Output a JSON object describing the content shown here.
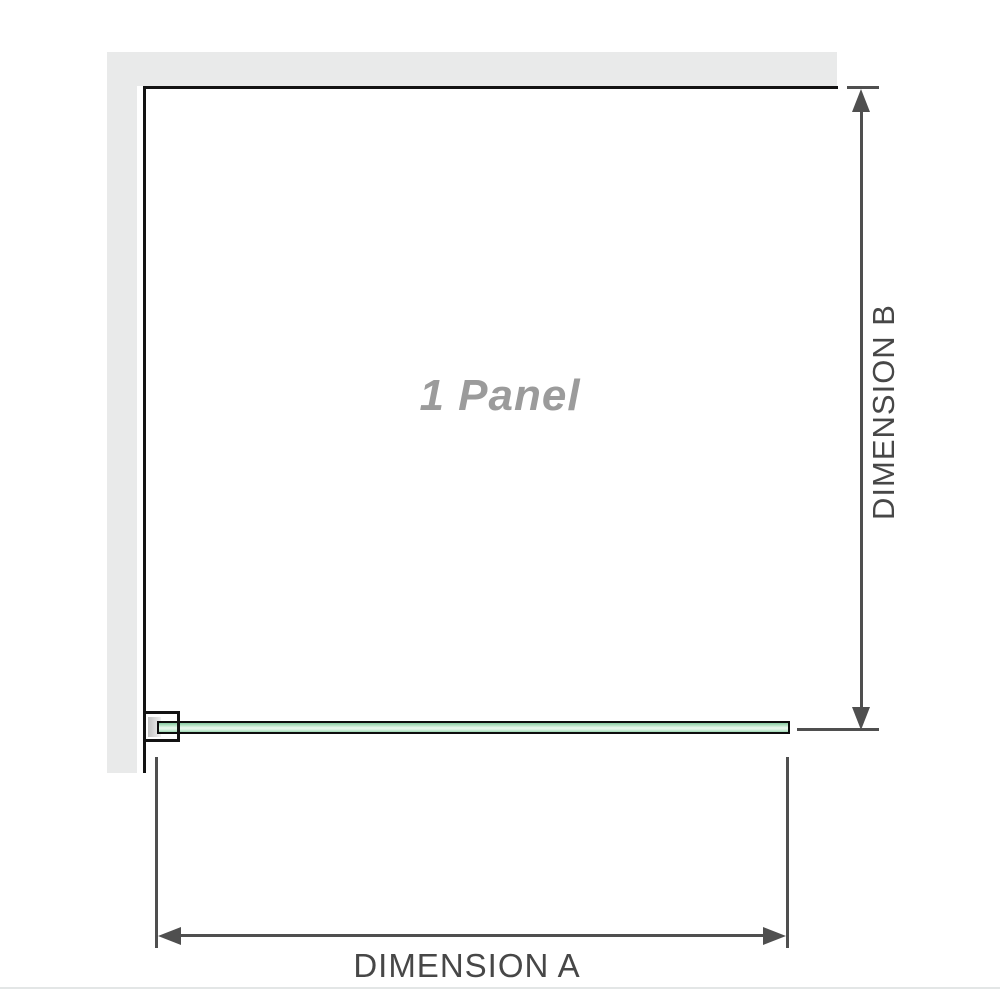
{
  "diagram": {
    "panel_label": "1 Panel",
    "dimension_a_label": "DIMENSION A",
    "dimension_b_label": "DIMENSION B"
  },
  "colors": {
    "wall": "#e9eaea",
    "outline": "#131313",
    "dimension": "#4f4f4f",
    "label": "#474747",
    "panel-label": "#9b9b9b",
    "glass-light": "#ecf9f0",
    "glass-border": "#0d0d0d",
    "bracket-gray": "#c2c2c2",
    "baseline": "#e3e6e6"
  }
}
